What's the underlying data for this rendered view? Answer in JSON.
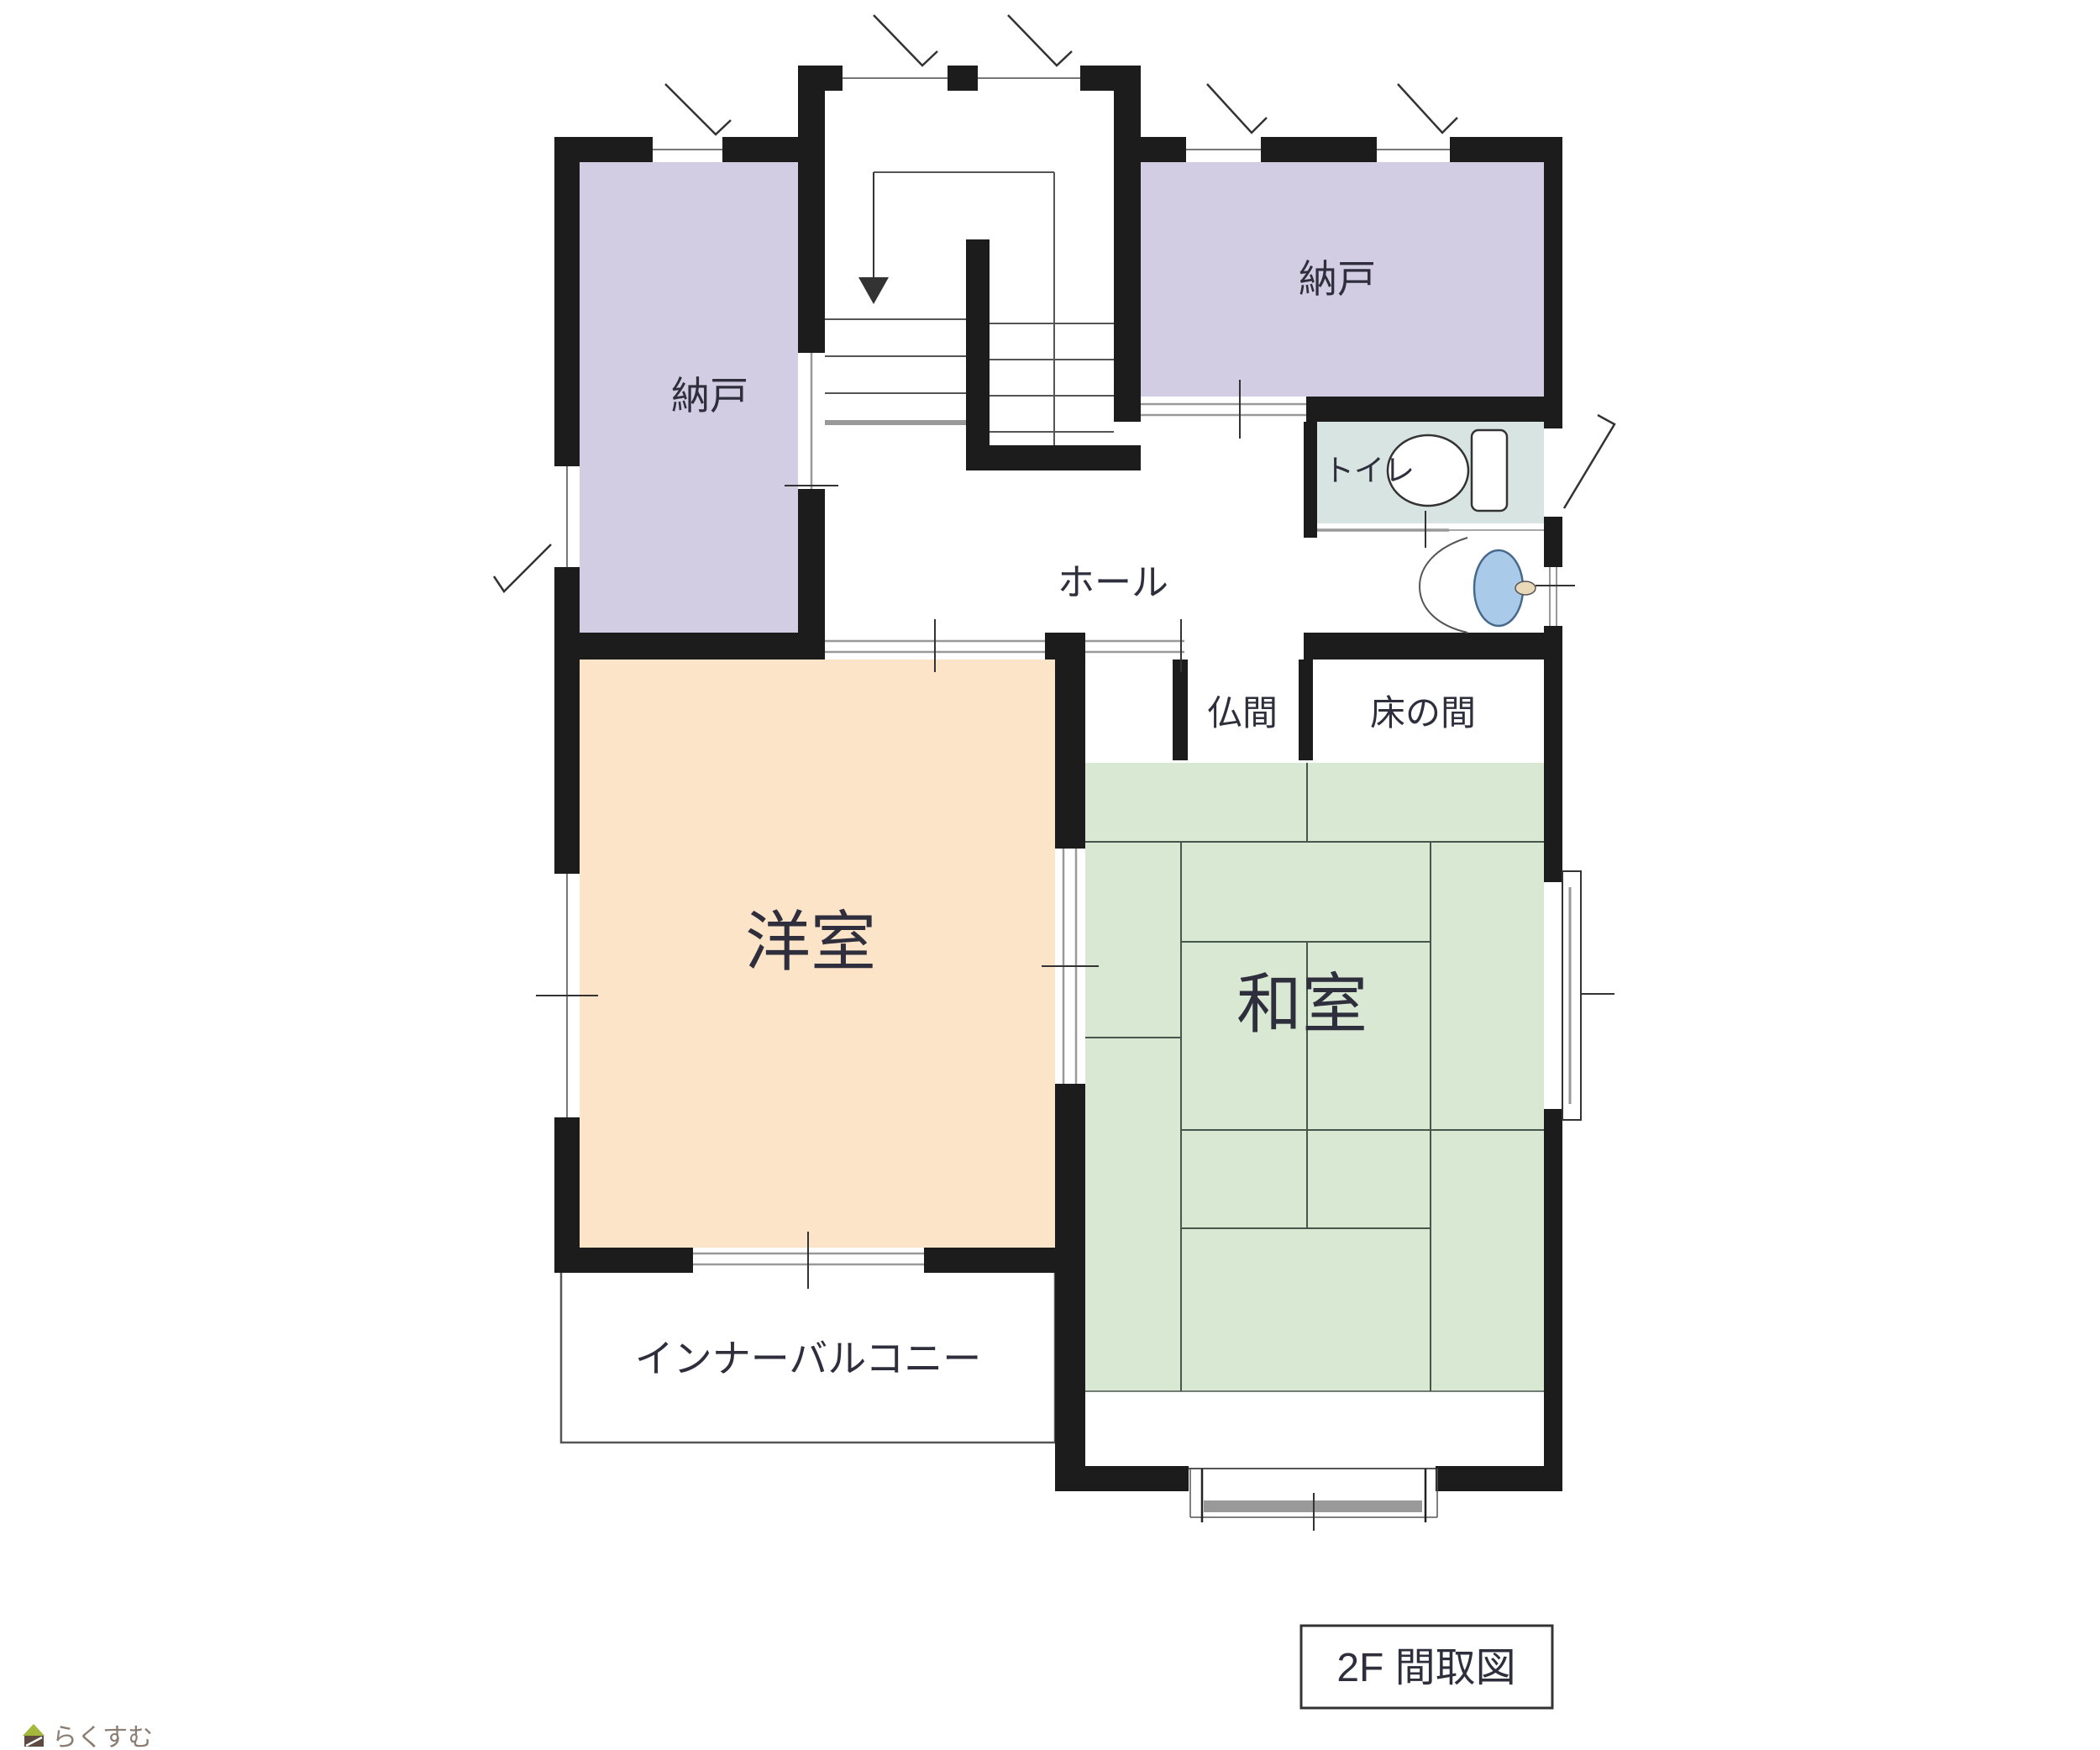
{
  "title": {
    "floor_label": "2F 間取図"
  },
  "watermark": {
    "logo_text": "らくすむ"
  },
  "rooms": {
    "nando_left": {
      "label": "納戸"
    },
    "nando_right": {
      "label": "納戸"
    },
    "toilet": {
      "label": "トイレ"
    },
    "hall": {
      "label": "ホール"
    },
    "butsuma": {
      "label": "仏間"
    },
    "tokonoma": {
      "label": "床の間"
    },
    "western_room": {
      "label": "洋室"
    },
    "japanese_room": {
      "label": "和室"
    },
    "inner_balcony": {
      "label": "インナーバルコニー"
    }
  },
  "colors": {
    "wall": "#1c1c1c",
    "storage_fill": "#d3cde3",
    "toilet_fill": "#d8e4e1",
    "western_fill": "#fbe4c8",
    "japanese_fill": "#d9e8d2",
    "tatami_line": "#46564a",
    "basin_fill": "#a9cae8",
    "basin_stroke": "#47698e",
    "faucet_fill": "#ead9b8",
    "track_gray": "#999999",
    "logo_roof": "#a4b83b",
    "logo_body": "#5d4b41",
    "logo_text_color": "#8b7d72",
    "background": "#ffffff"
  }
}
